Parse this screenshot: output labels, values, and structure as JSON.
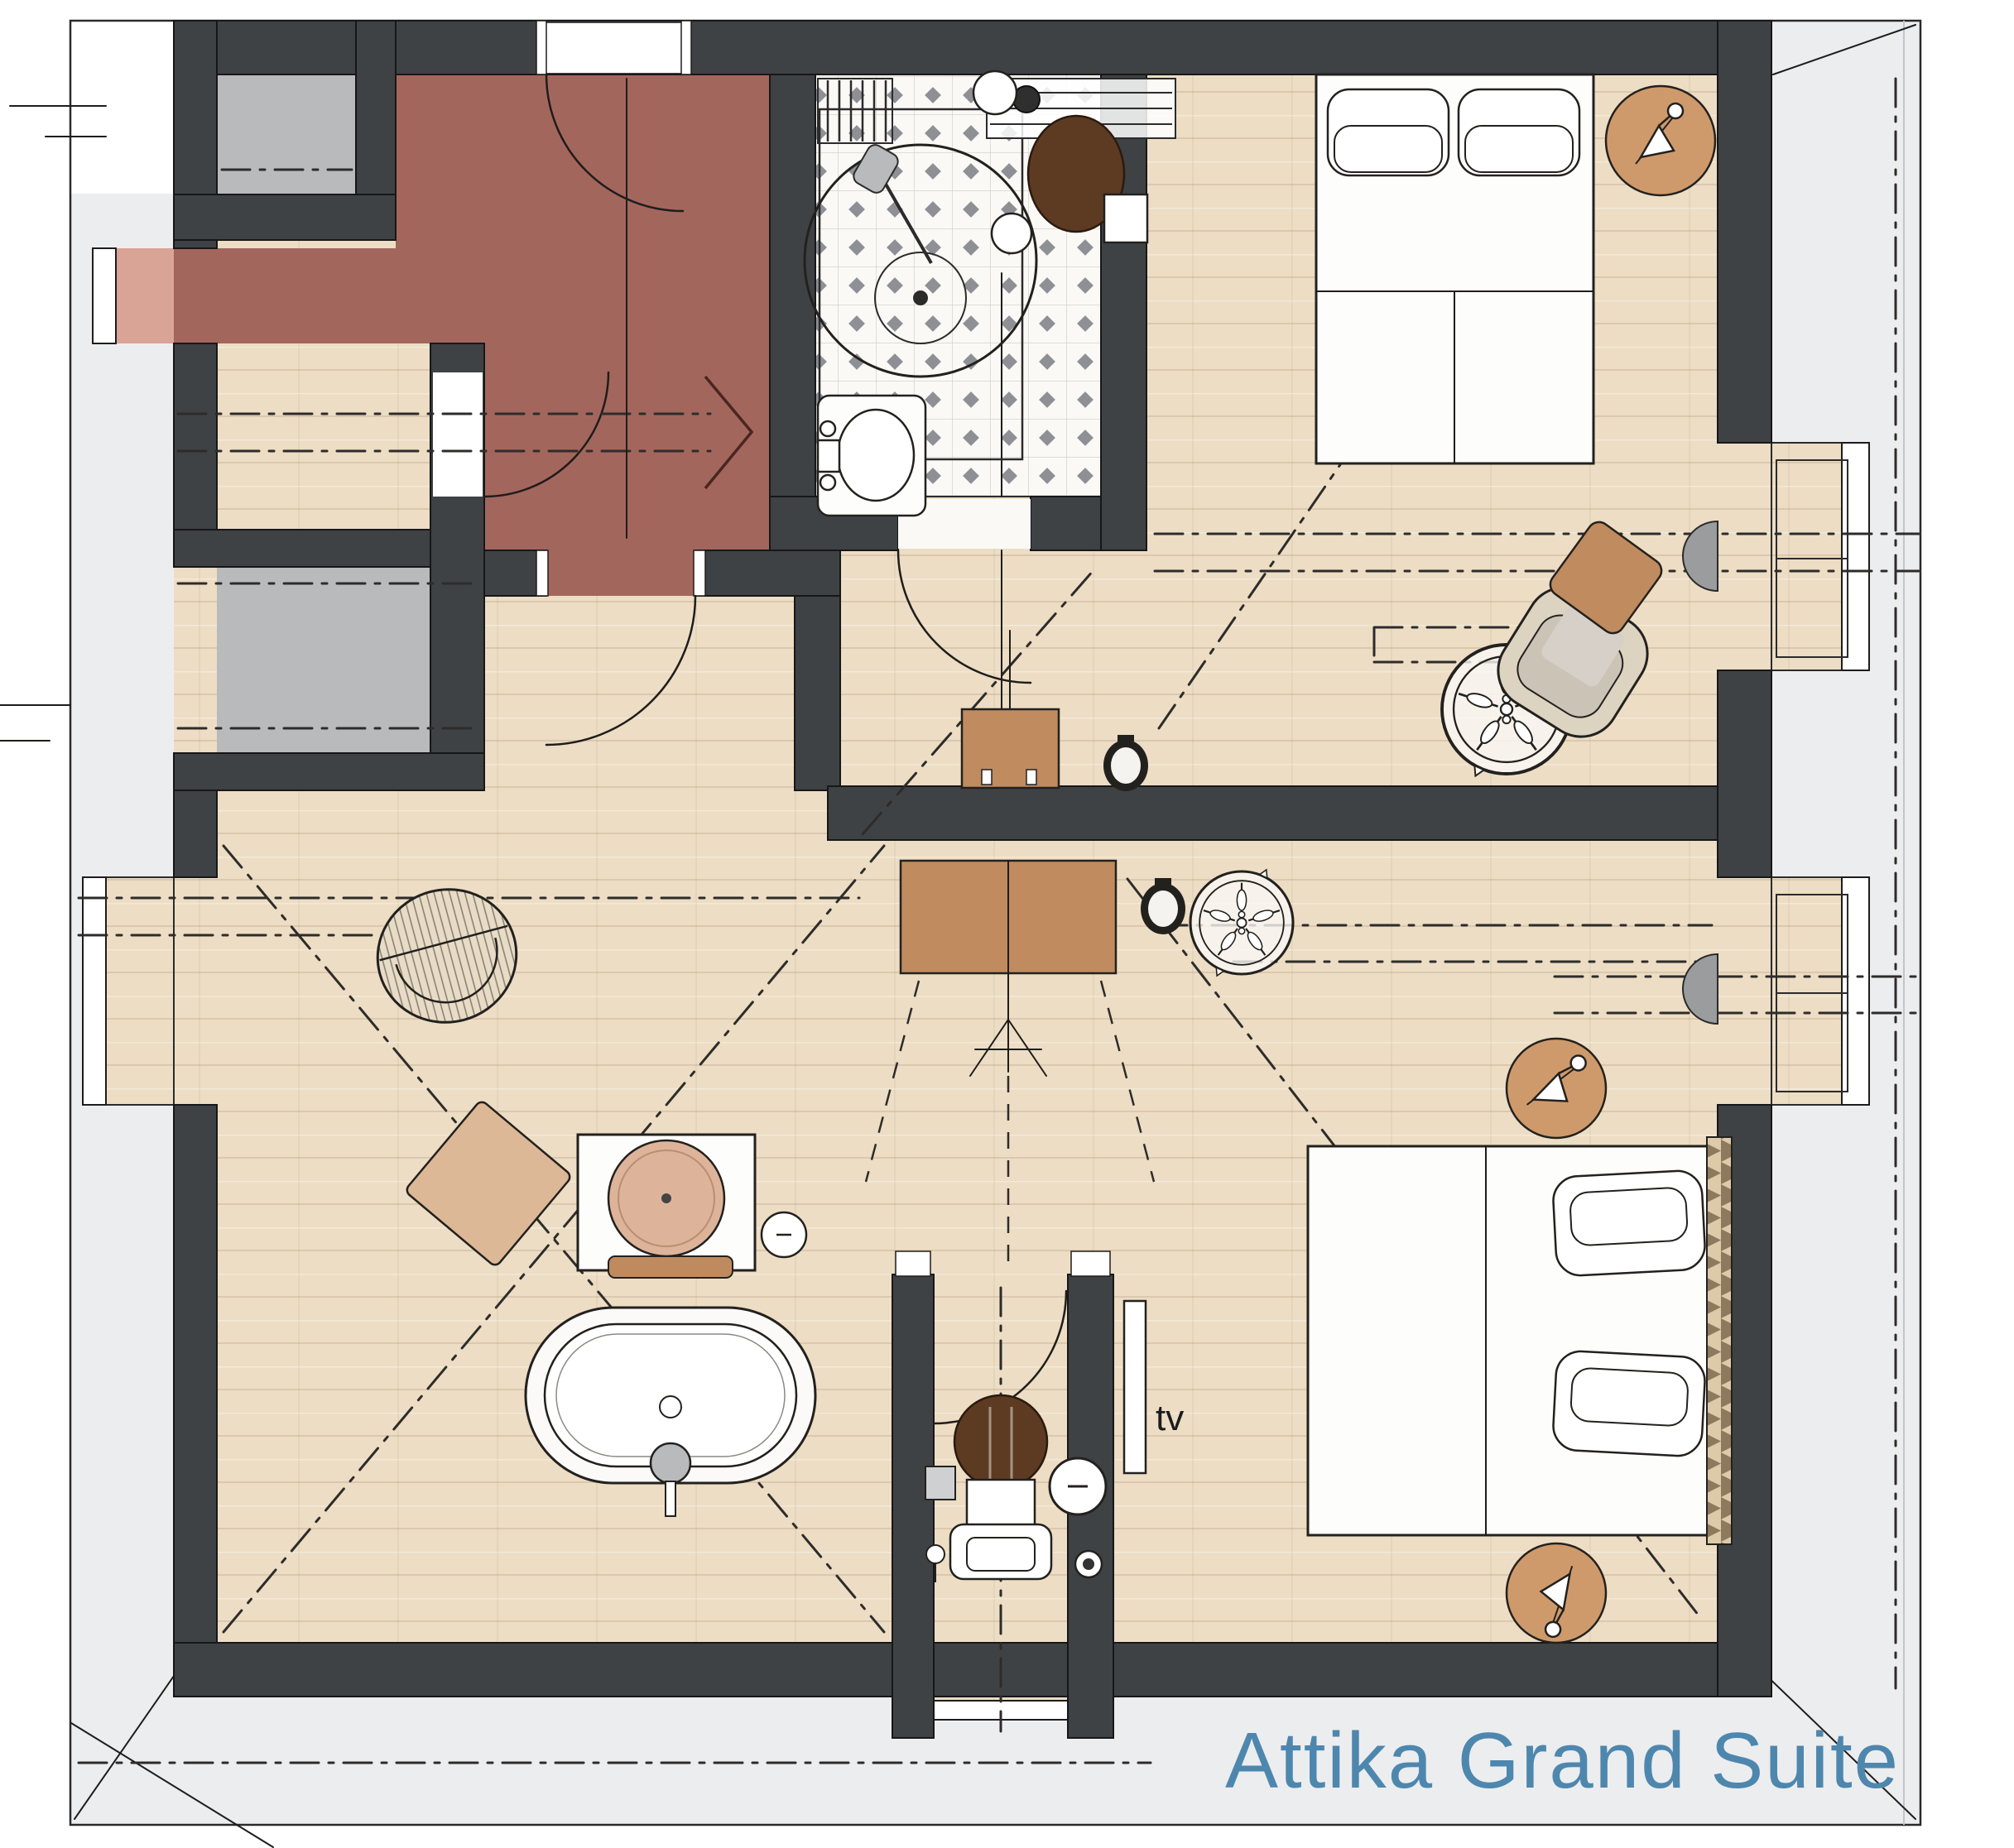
{
  "title": {
    "text": "Attika Grand Suite",
    "color": "#4e87ae"
  },
  "annotations": {
    "tv_label": "tv"
  },
  "palette": {
    "wall": "#3f4244",
    "wood_floor": "#ecddc4",
    "corridor_red": "#a3665d",
    "dormer_pink": "#d9a396",
    "shaft_gray": "#b9babc",
    "roof_band": "#ecedef",
    "tile_base": "#faf9f6",
    "tile_diamond": "#8e9095",
    "furniture_tan": "#c08b5f",
    "side_table_tan": "#cf9a6b",
    "toilet_brown": "#5d3b22",
    "line_dark": "#1f1d1b"
  },
  "plan": {
    "type": "hotel-suite-floor-plan",
    "rooms": [
      {
        "name": "stair-corridor"
      },
      {
        "name": "shaft-room-upper"
      },
      {
        "name": "shaft-room-lower"
      },
      {
        "name": "bathroom"
      },
      {
        "name": "bedroom-1"
      },
      {
        "name": "living-area"
      },
      {
        "name": "wc"
      },
      {
        "name": "bedroom-2"
      },
      {
        "name": "roof-terrace-band"
      }
    ],
    "fixtures": [
      "round-shower",
      "washbasin",
      "wall-hung-toilet",
      "towel-radiator",
      "freestanding-bathtub",
      "vanity-with-round-basin",
      "stool",
      "wc-toilet",
      "toilet-paper-holder",
      "wall-tv",
      "double-bed-1",
      "double-bed-2",
      "bedside-tables-with-lamps",
      "ceiling-fan-1",
      "ceiling-fan-2",
      "speakers",
      "wall-lamps",
      "wicker-chair",
      "armchair",
      "ottoman",
      "pouf",
      "tv-sideboard-upper",
      "tv-sideboard-lower",
      "dormer-desk-bay-1",
      "dormer-desk-bay-2",
      "entry-arrow"
    ]
  }
}
